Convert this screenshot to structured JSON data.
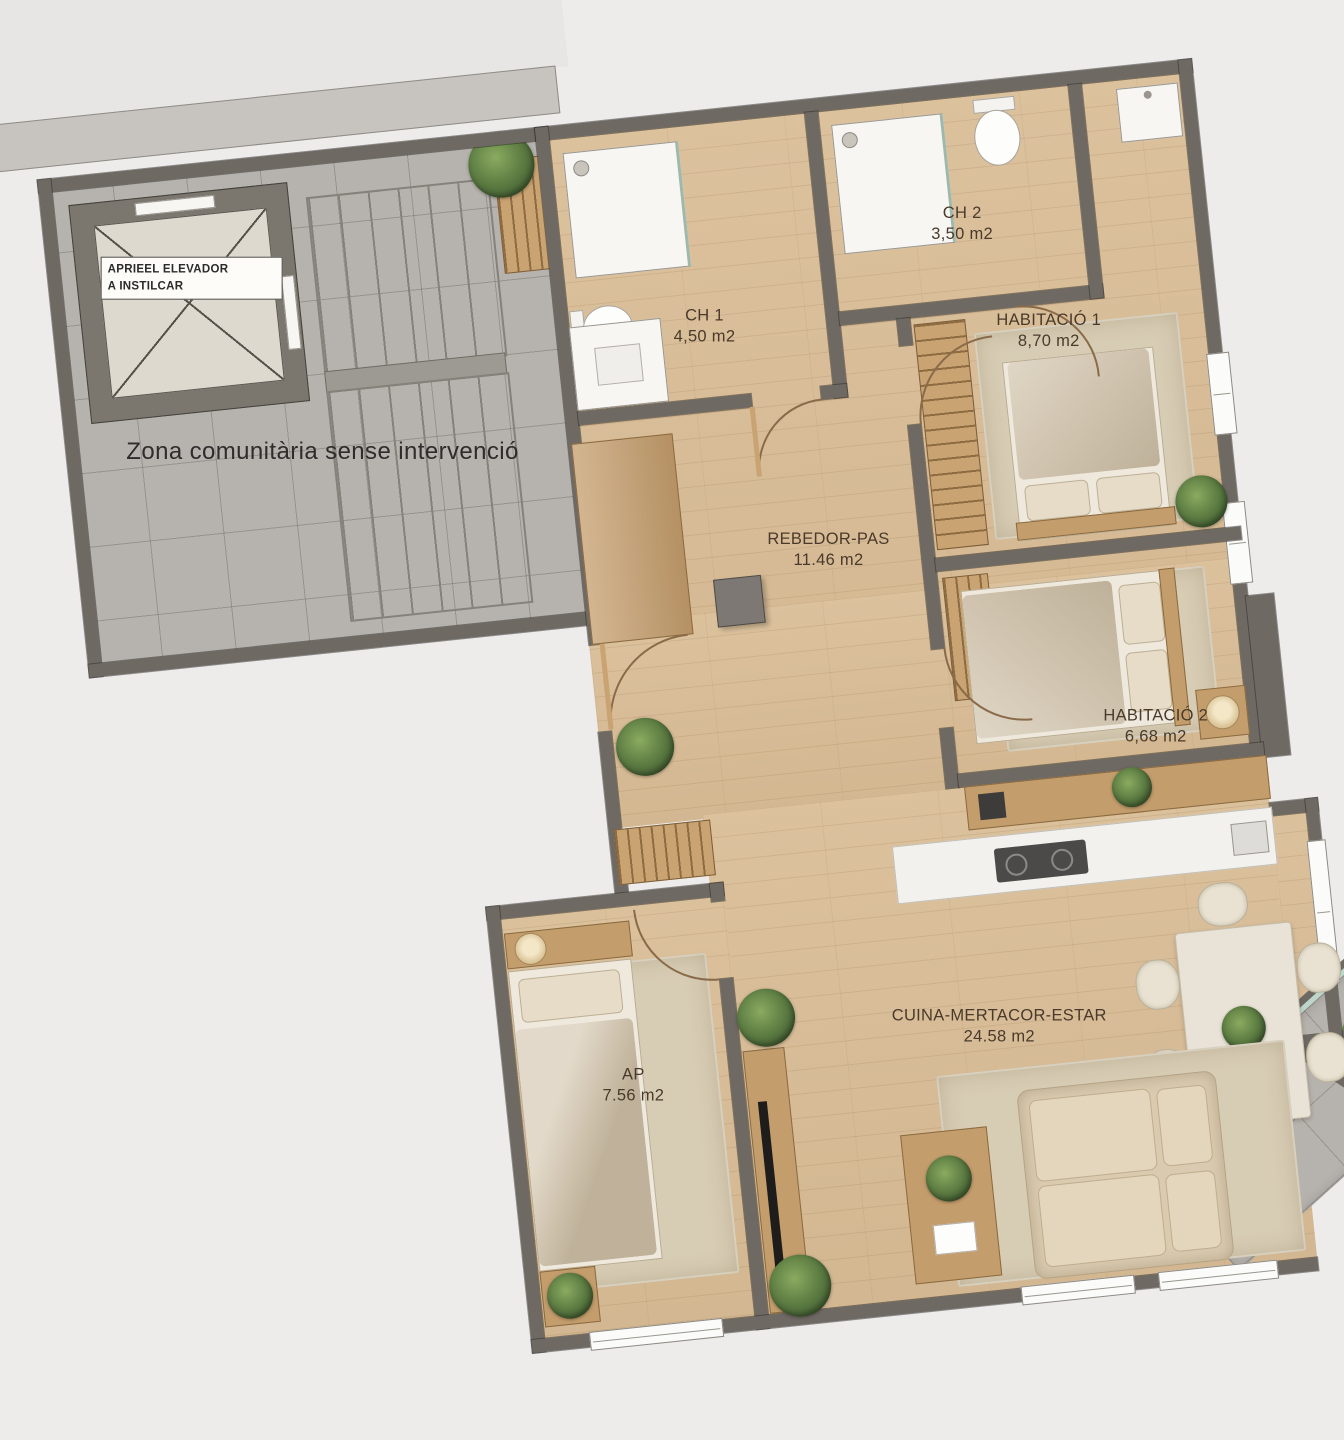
{
  "title": "Floor plan",
  "palette": {
    "background": "#edecea",
    "wall": "#6e6963",
    "wood_floor": "#d9bd96",
    "tile_floor": "#b6b2ad",
    "rug": "#d7ccb4",
    "label_text": "#4a3a2b",
    "plant_green": "#5d7d43",
    "fixture_white": "#f7f6f3"
  },
  "communal": {
    "zone_label": "Zona comunitària sense intervenció",
    "elevator_label_line1": "APRIEEL ELEVADOR",
    "elevator_label_line2": "A INSTILCAR"
  },
  "rooms": [
    {
      "id": "ch2",
      "name": "CH 2",
      "area": "3,50 m2"
    },
    {
      "id": "habitacio1",
      "name": "HABITACIÓ 1",
      "area": "8,70 m2"
    },
    {
      "id": "ch1",
      "name": "CH 1",
      "area": "4,50 m2"
    },
    {
      "id": "habitacio2",
      "name": "HABITACIÓ 2",
      "area": "6,68 m2"
    },
    {
      "id": "rebedor",
      "name": "REBEDOR-PAS",
      "area": "11.46 m2"
    },
    {
      "id": "ap",
      "name": "AP",
      "area": "7.56 m2"
    },
    {
      "id": "cuina",
      "name": "CUINA-MERTACOR-ESTAR",
      "area": "24.58 m2"
    }
  ]
}
